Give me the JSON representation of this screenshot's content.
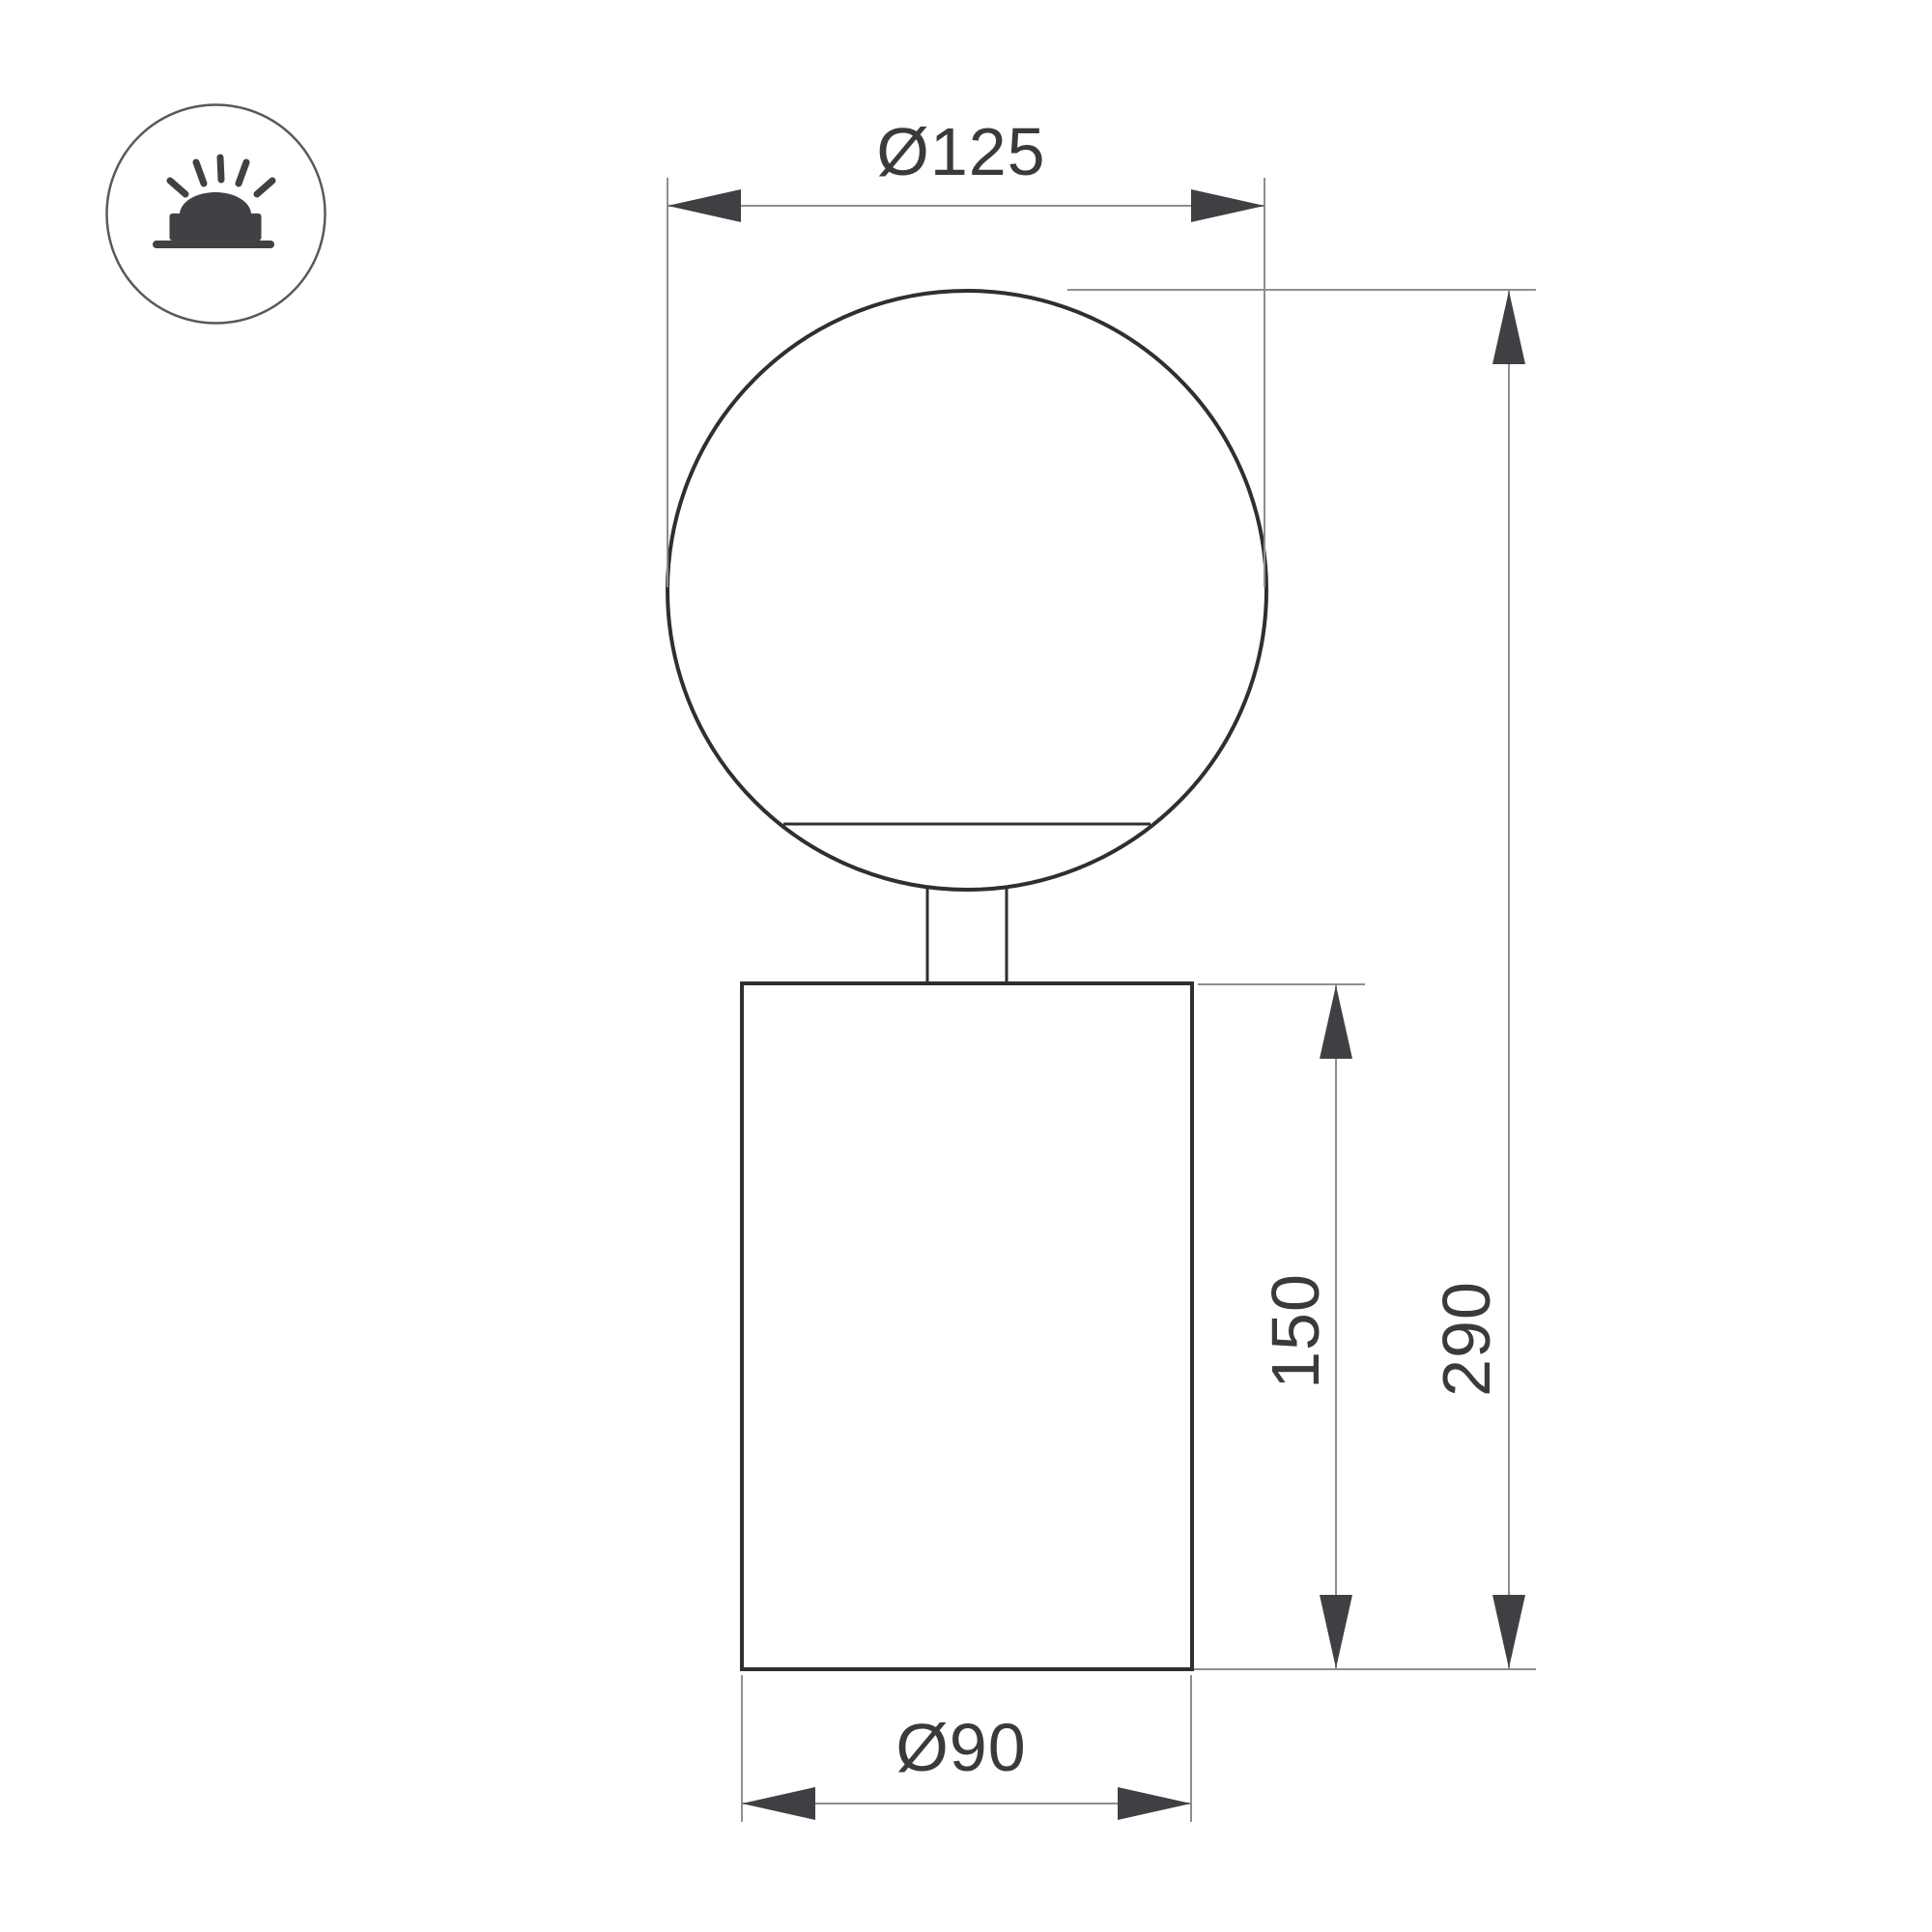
{
  "drawing": {
    "type": "technical-dimension-drawing",
    "product": "sphere-on-cylinder table lamp",
    "labels": {
      "sphere_diameter": "Ø125",
      "body_height": "150",
      "total_height": "290",
      "body_diameter": "Ø90"
    },
    "icon": {
      "name": "surface-mounted-luminaire",
      "description": "glowing dome lamp on a surface base inside a circle"
    },
    "colors": {
      "background": "#ffffff",
      "outline": "#2f2f31",
      "dimension_line": "#8e8e8e",
      "arrow": "#3f4044",
      "text": "#3a3a3d",
      "icon": "#414145"
    }
  }
}
